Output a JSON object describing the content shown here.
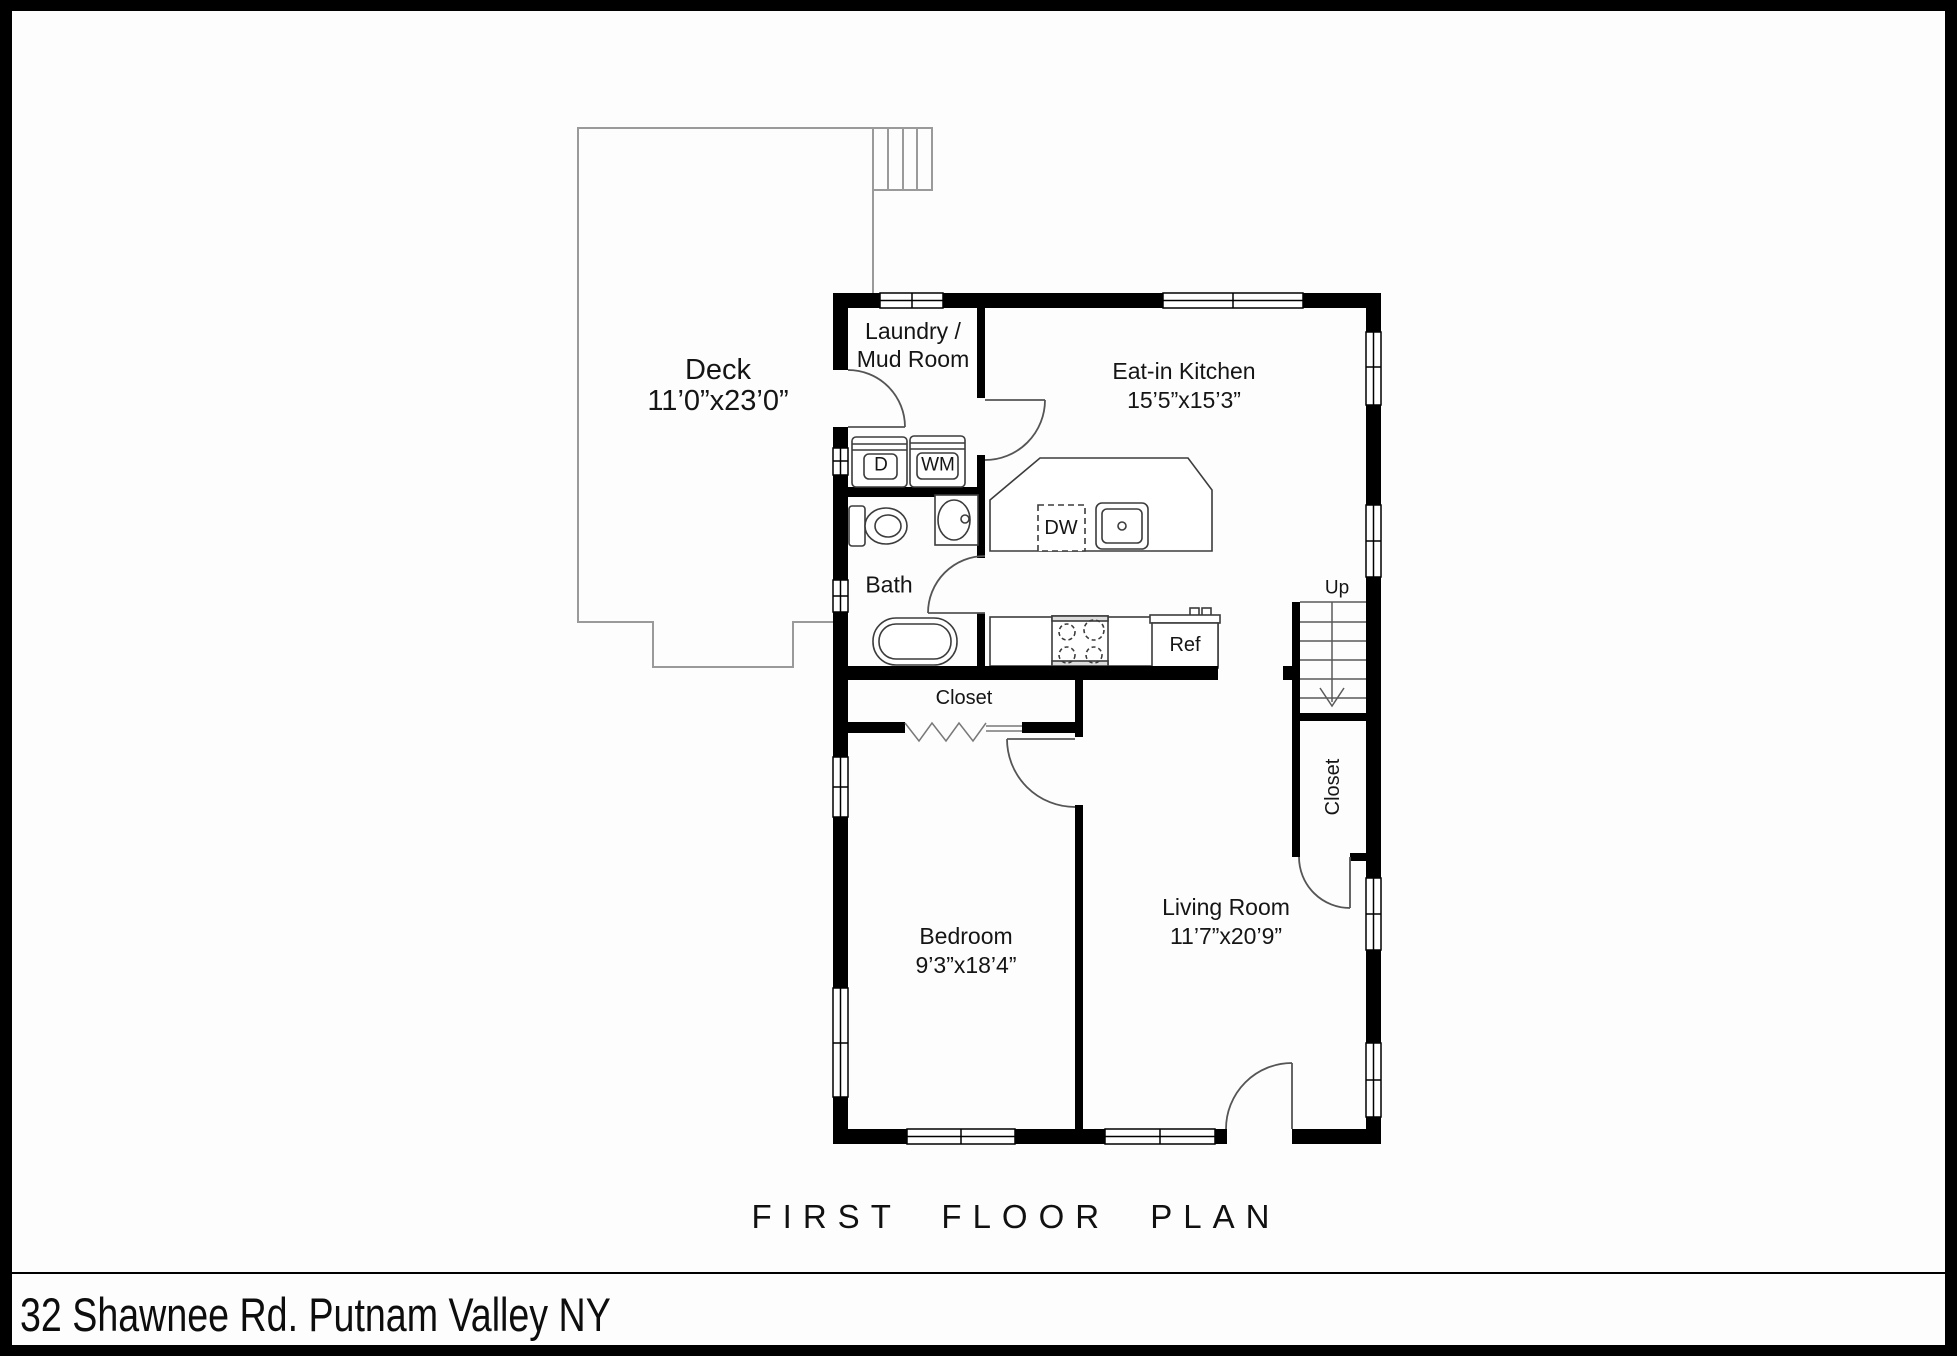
{
  "rooms": {
    "deck": {
      "name": "Deck",
      "dims": "11’0”x23’0”"
    },
    "laundry": {
      "line1": "Laundry /",
      "line2": "Mud Room"
    },
    "kitchen": {
      "name": "Eat-in Kitchen",
      "dims": "15’5”x15’3”"
    },
    "bath": {
      "name": "Bath"
    },
    "bedroom_closet": {
      "name": "Closet"
    },
    "stairs_closet": {
      "name": "Closet"
    },
    "bedroom": {
      "name": "Bedroom",
      "dims": "9’3”x18’4”"
    },
    "living_room": {
      "name": "Living Room",
      "dims": "11’7”x20’9”"
    }
  },
  "appliances": {
    "dryer": "D",
    "washer": "WM",
    "dishwasher": "DW",
    "refrigerator": "Ref"
  },
  "stairs": {
    "direction": "Up"
  },
  "colors": {
    "wall": "#000000",
    "deck_line": "#9a9a9a",
    "fixture_line": "#3c3c3c"
  },
  "footer": {
    "plan_title": "FIRST FLOOR PLAN",
    "address": "32 Shawnee Rd. Putnam Valley NY"
  }
}
